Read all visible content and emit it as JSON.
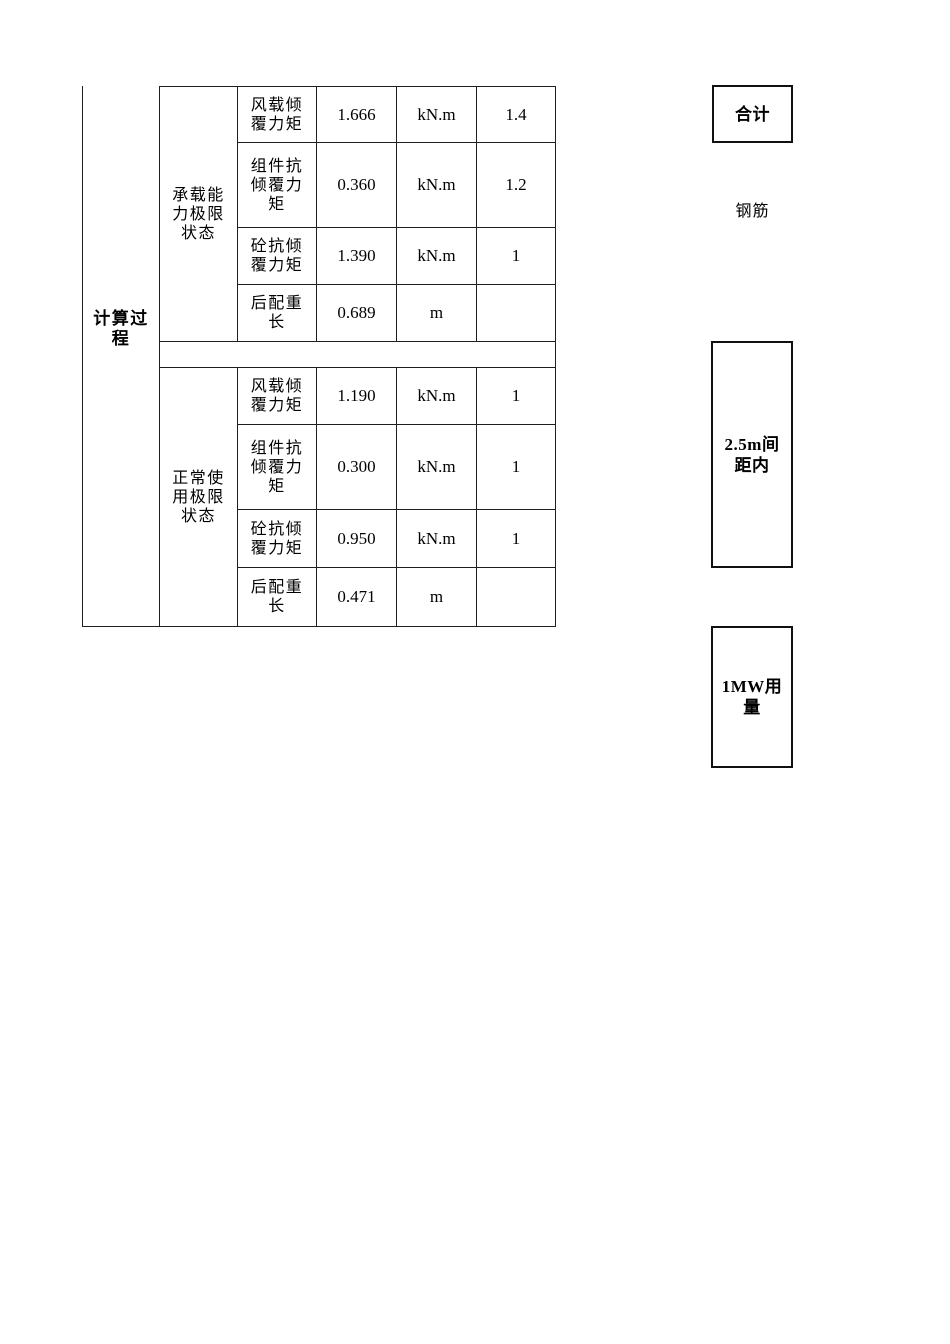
{
  "table": {
    "process_label": "计算过程",
    "spacer": "",
    "sections": [
      {
        "state_label": "承载能力极限状态",
        "rows": [
          {
            "item": "风载倾覆力矩",
            "value": "1.666",
            "unit": "kN.m",
            "factor": "1.4"
          },
          {
            "item": "组件抗倾覆力矩",
            "value": "0.360",
            "unit": "kN.m",
            "factor": "1.2"
          },
          {
            "item": "砼抗倾覆力矩",
            "value": "1.390",
            "unit": "kN.m",
            "factor": "1"
          },
          {
            "item": "后配重长",
            "value": "0.689",
            "unit": "m",
            "factor": ""
          }
        ]
      },
      {
        "state_label": "正常使用极限状态",
        "rows": [
          {
            "item": "风载倾覆力矩",
            "value": "1.190",
            "unit": "kN.m",
            "factor": "1"
          },
          {
            "item": "组件抗倾覆力矩",
            "value": "0.300",
            "unit": "kN.m",
            "factor": "1"
          },
          {
            "item": "砼抗倾覆力矩",
            "value": "0.950",
            "unit": "kN.m",
            "factor": "1"
          },
          {
            "item": "后配重长",
            "value": "0.471",
            "unit": "m",
            "factor": ""
          }
        ]
      }
    ]
  },
  "side_notes": {
    "total": "合计",
    "rebar": "钢筋",
    "spacing": "2.5m间距内",
    "usage": "1MW用量"
  },
  "colors": {
    "table_border": "#1f1f1f",
    "note_border": "#111111",
    "text": "#000000",
    "background": "#ffffff"
  }
}
